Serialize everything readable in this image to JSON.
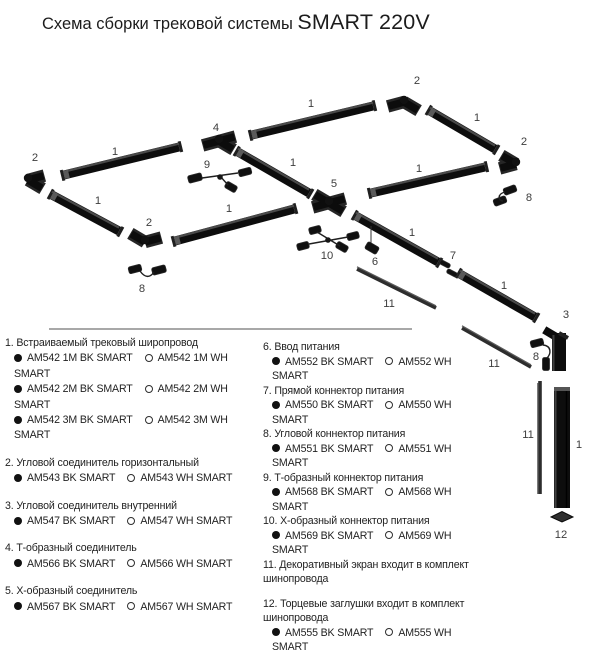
{
  "title": {
    "prefix": "Схема сборки трековой системы",
    "brand": "SMART 220V"
  },
  "colors": {
    "track": "#0d0d0d",
    "highlight": "#4a4a4a",
    "screen": "#2d2d2d",
    "divider": "#a8a8a8",
    "black_variant_dot": "#111111",
    "white_variant_dot": "#ffffff",
    "callout_text": "#3d3d3d"
  },
  "callouts": [
    {
      "n": "2",
      "x": 35,
      "y": 161
    },
    {
      "n": "1",
      "x": 115,
      "y": 155
    },
    {
      "n": "4",
      "x": 216,
      "y": 131
    },
    {
      "n": "9",
      "x": 207,
      "y": 168
    },
    {
      "n": "1",
      "x": 311,
      "y": 107
    },
    {
      "n": "2",
      "x": 417,
      "y": 84
    },
    {
      "n": "1",
      "x": 477,
      "y": 121
    },
    {
      "n": "2",
      "x": 524,
      "y": 145
    },
    {
      "n": "8",
      "x": 529,
      "y": 201
    },
    {
      "n": "1",
      "x": 98,
      "y": 204
    },
    {
      "n": "1",
      "x": 293,
      "y": 166
    },
    {
      "n": "2",
      "x": 149,
      "y": 226
    },
    {
      "n": "8",
      "x": 142,
      "y": 292
    },
    {
      "n": "1",
      "x": 229,
      "y": 212
    },
    {
      "n": "5",
      "x": 334,
      "y": 187
    },
    {
      "n": "10",
      "x": 327,
      "y": 259
    },
    {
      "n": "1",
      "x": 419,
      "y": 172
    },
    {
      "n": "6",
      "x": 375,
      "y": 265
    },
    {
      "n": "1",
      "x": 412,
      "y": 236
    },
    {
      "n": "7",
      "x": 453,
      "y": 259
    },
    {
      "n": "11",
      "x": 389,
      "y": 307
    },
    {
      "n": "1",
      "x": 504,
      "y": 289
    },
    {
      "n": "3",
      "x": 566,
      "y": 318
    },
    {
      "n": "8",
      "x": 536,
      "y": 360
    },
    {
      "n": "11",
      "x": 494,
      "y": 367
    },
    {
      "n": "11",
      "x": 528,
      "y": 438
    },
    {
      "n": "1",
      "x": 579,
      "y": 448
    },
    {
      "n": "12",
      "x": 561,
      "y": 538
    }
  ],
  "legend": {
    "left": [
      {
        "num": "1",
        "name": "Встраиваемый трековый широпровод",
        "variants": [
          {
            "bk": "AM542 1M BK SMART",
            "wh": "AM542 1M WH SMART"
          },
          {
            "bk": "AM542 2M BK SMART",
            "wh": "AM542 2M WH SMART"
          },
          {
            "bk": "AM542 3M BK SMART",
            "wh": "AM542 3M WH SMART"
          }
        ]
      },
      {
        "num": "2",
        "name": "Угловой соединитель горизонтальный",
        "variants": [
          {
            "bk": "AM543 BK SMART",
            "wh": "AM543 WH SMART"
          }
        ]
      },
      {
        "num": "3",
        "name": "Угловой соединитель внутренний",
        "variants": [
          {
            "bk": "AM547 BK SMART",
            "wh": "AM547 WH SMART"
          }
        ]
      },
      {
        "num": "4",
        "name": "Т-образный соединитель",
        "variants": [
          {
            "bk": "AM566 BK SMART",
            "wh": "AM566 WH SMART"
          }
        ]
      },
      {
        "num": "5",
        "name": "Х-образный соединитель",
        "variants": [
          {
            "bk": "AM567 BK SMART",
            "wh": "AM567 WH SMART"
          }
        ]
      }
    ],
    "right": [
      {
        "num": "6",
        "name": "Ввод питания",
        "variants": [
          {
            "bk": "AM552 BK SMART",
            "wh": "AM552 WH SMART"
          }
        ]
      },
      {
        "num": "7",
        "name": "Прямой коннектор питания",
        "variants": [
          {
            "bk": "AM550 BK SMART",
            "wh": "AM550 WH SMART"
          }
        ]
      },
      {
        "num": "8",
        "name": "Угловой коннектор питания",
        "variants": [
          {
            "bk": "AM551 BK SMART",
            "wh": "AM551 WH SMART"
          }
        ]
      },
      {
        "num": "9",
        "name": "Т-образный коннектор питания",
        "variants": [
          {
            "bk": "AM568 BK SMART",
            "wh": "AM568 WH SMART"
          }
        ]
      },
      {
        "num": "10",
        "name": "Х-образный коннектор питания",
        "variants": [
          {
            "bk": "AM569 BK SMART",
            "wh": "AM569 WH SMART"
          }
        ]
      },
      {
        "num": "11",
        "name": "Декоративный экран входит в комплект шинопровода",
        "variants": []
      },
      {
        "num": "12",
        "name": "Торцевые заглушки  входит в комплект шинопровода",
        "gap_before": true,
        "variants": [
          {
            "bk": "AM555 BK SMART",
            "wh": "AM555 WH SMART"
          }
        ]
      }
    ]
  }
}
